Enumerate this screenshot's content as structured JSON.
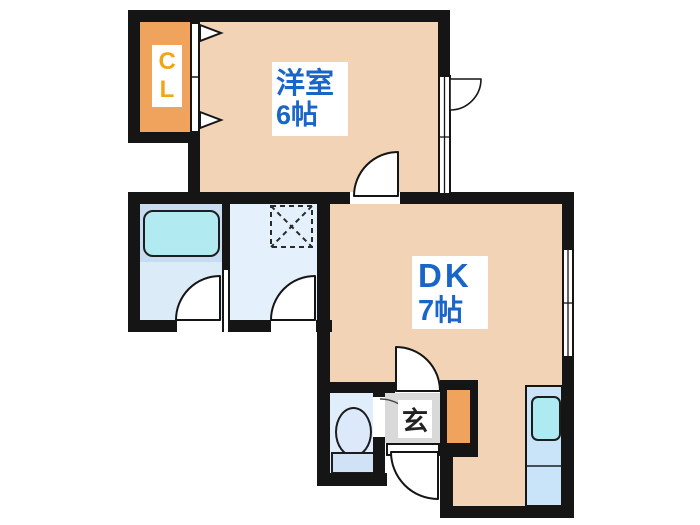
{
  "floorplan": {
    "rooms": {
      "western": {
        "name": "洋室",
        "size": "6帖"
      },
      "dining_kitchen": {
        "name": "DK",
        "size": "7帖"
      },
      "closet": {
        "label": "CL"
      },
      "entrance": {
        "label": "玄"
      }
    },
    "fixtures": [
      "bathtub",
      "washing-machine-space",
      "toilet",
      "kitchen-sink",
      "shoe-cabinet"
    ],
    "colors": {
      "wall": "#151515",
      "room_fill": "#f2d3b6",
      "closet_fill": "#f0a35c",
      "closet_text": "#f2a516",
      "room_label_text": "#1a66c8",
      "bathroom_floor": "#dcebf8",
      "tub_band": "#c7dcf0",
      "bathtub_fill": "#b2eaf2",
      "washroom_fill": "#e4f1fc",
      "toilet_room_fill": "#e0eefb",
      "kitchen_fill": "#c9e4f8",
      "sink_fill": "#aeeaf2",
      "entrance_floor": "#d9d9d9"
    }
  }
}
